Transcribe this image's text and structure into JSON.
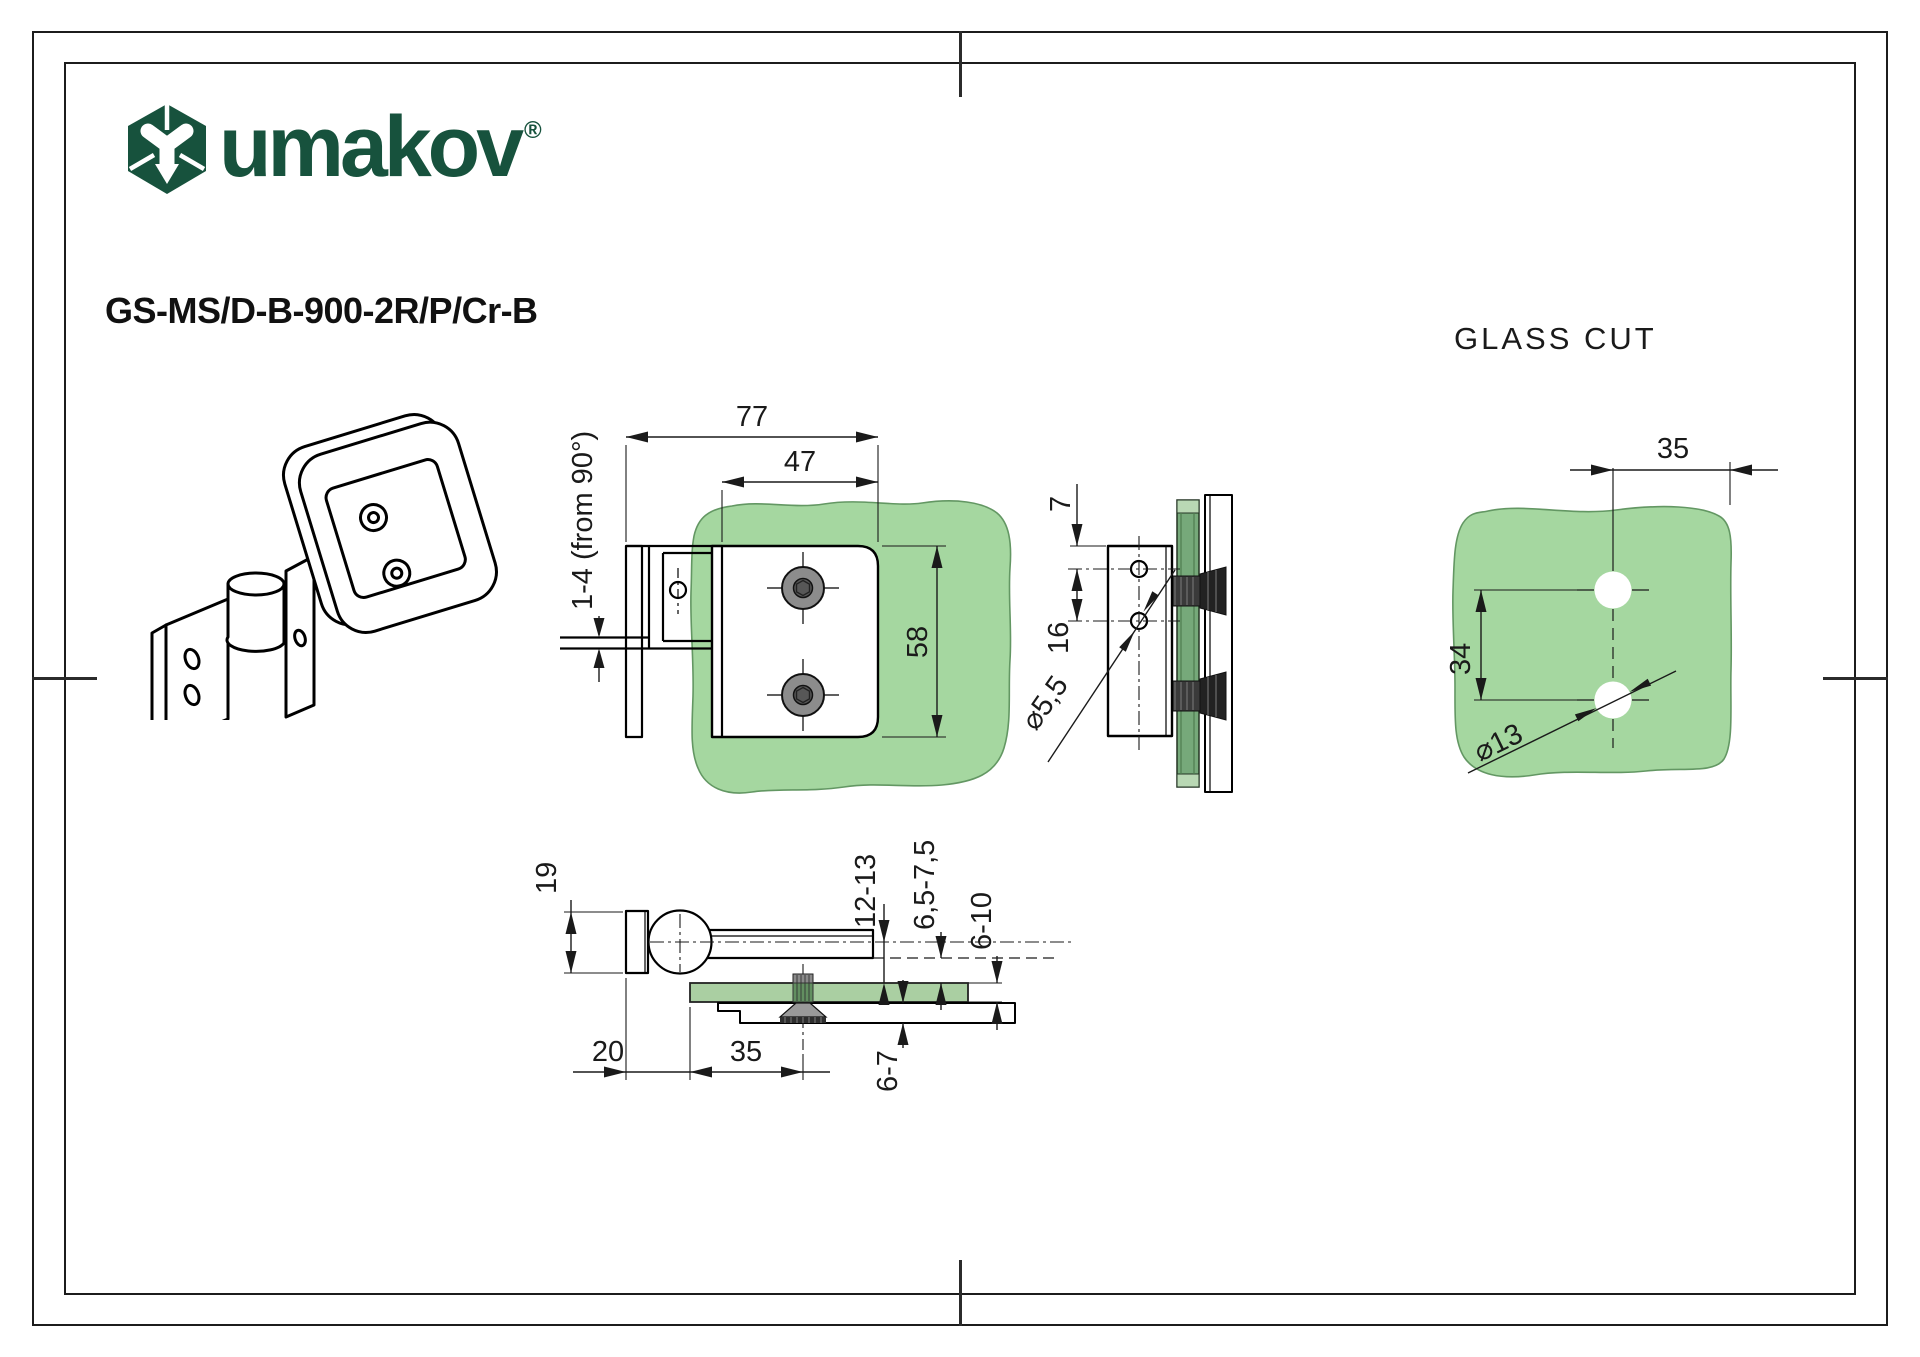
{
  "brand": {
    "logo_text": "umakov",
    "registered_mark": "®"
  },
  "product_code": "GS-MS/D-B-900-2R/P/Cr-B",
  "colors": {
    "logo_green": "#17523d",
    "glass_light": "#a5d7a0",
    "glass_dark": "#76a97a",
    "line_black": "#1a1a1a",
    "screw_gray": "#8c8c8c"
  },
  "front_view": {
    "total_width": "77",
    "plate_width": "47",
    "plate_height": "58",
    "adjust_range": "1-4 (from 90°)"
  },
  "side_view": {
    "edge_offset": "7",
    "hole_spacing": "16",
    "hole_diameter": "⌀5,5"
  },
  "glass_cut": {
    "title": "GLASS CUT",
    "edge_offset": "35",
    "hole_spacing": "34",
    "hole_diameter": "⌀13"
  },
  "bottom_view": {
    "knuckle_width": "19",
    "plate_offset": "20",
    "screw_offset": "35",
    "pivot_to_glass": "12-13",
    "clamp_gap": "6,5-7,5",
    "glass_thickness": "6-10",
    "clamp_depth": "6-7"
  }
}
